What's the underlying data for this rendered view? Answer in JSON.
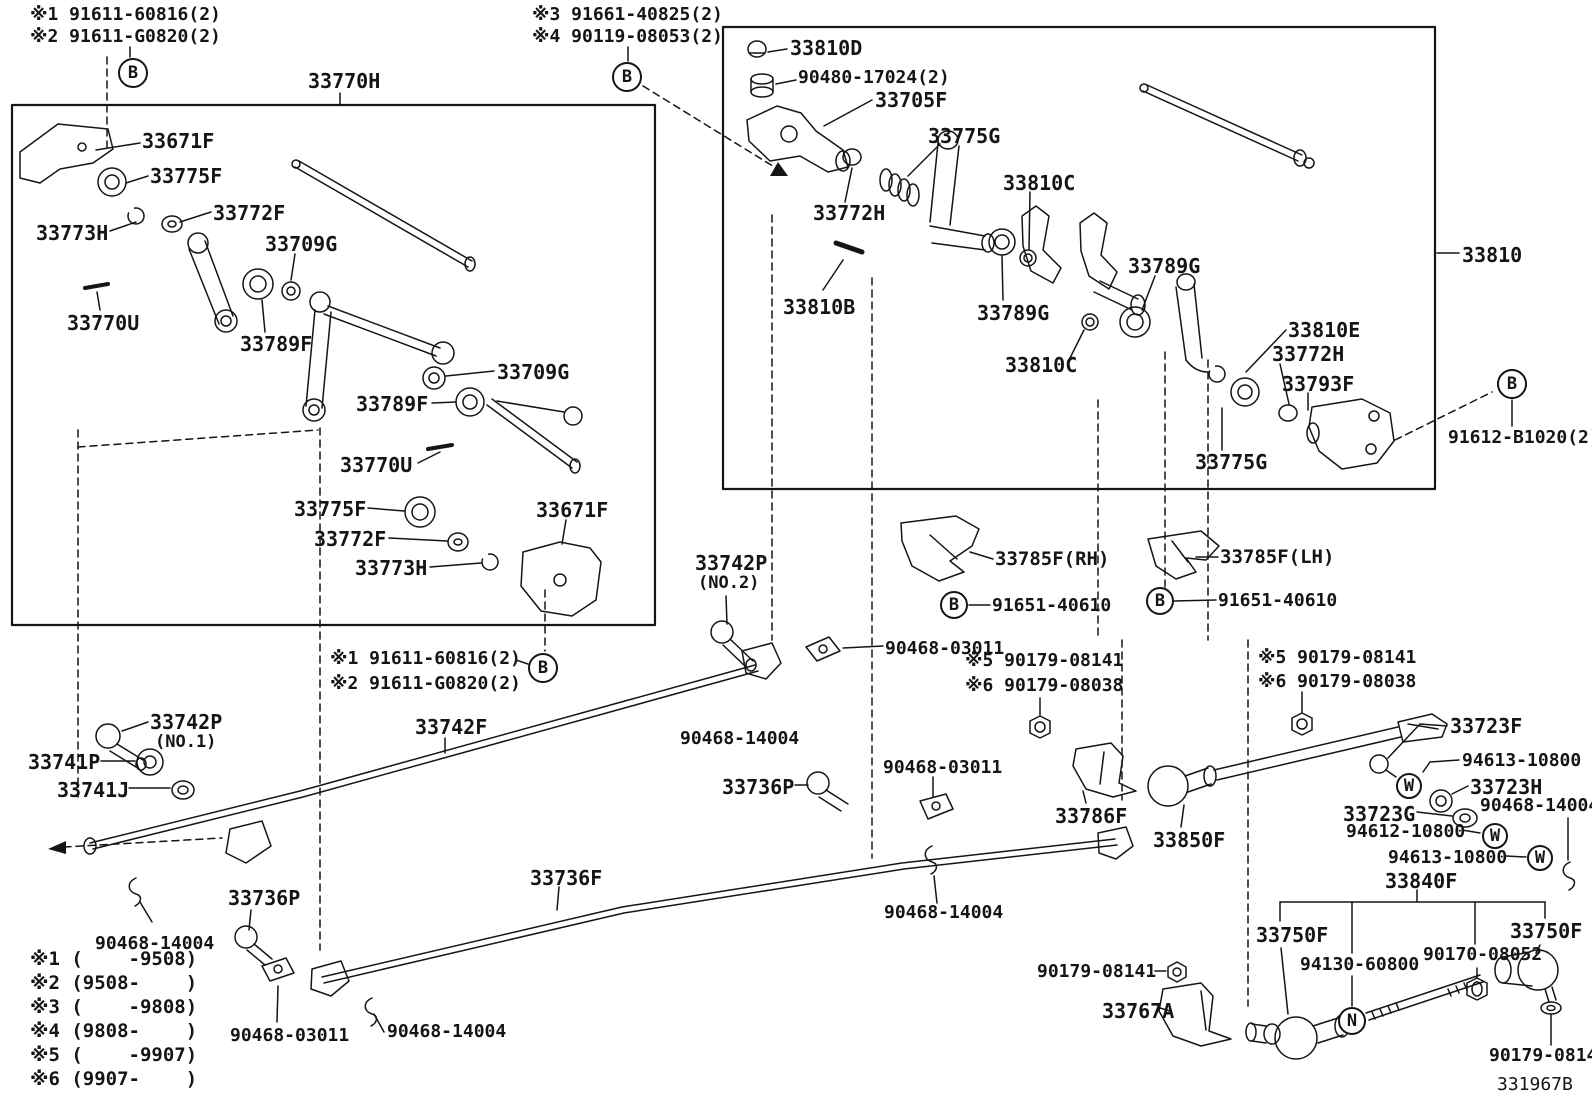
{
  "diagram": {
    "code": "331967B",
    "kind": "parts-diagram",
    "assembly_boxes": [
      {
        "id": "33770H",
        "position": "upper-left"
      },
      {
        "id": "33810",
        "position": "upper-right"
      }
    ]
  },
  "labels": [
    {
      "n": "note-ref1-top",
      "t": "※1 91611-60816(2)",
      "x": 30,
      "y": 6,
      "fs": 18
    },
    {
      "n": "note-ref2-top",
      "t": "※2 91611-G0820(2)",
      "x": 30,
      "y": 28,
      "fs": 18
    },
    {
      "n": "note-ref3-top",
      "t": "※3 91661-40825(2)",
      "x": 532,
      "y": 6,
      "fs": 18
    },
    {
      "n": "note-ref4-top",
      "t": "※4 90119-08053(2)",
      "x": 532,
      "y": 28,
      "fs": 18
    },
    {
      "n": "label-33770H",
      "t": "33770H",
      "x": 308,
      "y": 71,
      "fs": 20
    },
    {
      "n": "label-33671F-1",
      "t": "33671F",
      "x": 142,
      "y": 131,
      "fs": 20
    },
    {
      "n": "label-33775F-1",
      "t": "33775F",
      "x": 150,
      "y": 166,
      "fs": 20
    },
    {
      "n": "label-33772F-1",
      "t": "33772F",
      "x": 213,
      "y": 203,
      "fs": 20
    },
    {
      "n": "label-33773H-1",
      "t": "33773H",
      "x": 36,
      "y": 223,
      "fs": 20
    },
    {
      "n": "label-33709G-1",
      "t": "33709G",
      "x": 265,
      "y": 234,
      "fs": 20
    },
    {
      "n": "label-33770U-1",
      "t": "33770U",
      "x": 67,
      "y": 313,
      "fs": 20
    },
    {
      "n": "label-33789F-1",
      "t": "33789F",
      "x": 240,
      "y": 334,
      "fs": 20
    },
    {
      "n": "label-33709G-2",
      "t": "33709G",
      "x": 497,
      "y": 362,
      "fs": 20
    },
    {
      "n": "label-33789F-2",
      "t": "33789F",
      "x": 356,
      "y": 394,
      "fs": 20
    },
    {
      "n": "label-33770U-2",
      "t": "33770U",
      "x": 340,
      "y": 455,
      "fs": 20
    },
    {
      "n": "label-33775F-2",
      "t": "33775F",
      "x": 294,
      "y": 499,
      "fs": 20
    },
    {
      "n": "label-33772F-2",
      "t": "33772F",
      "x": 314,
      "y": 529,
      "fs": 20
    },
    {
      "n": "label-33773H-2",
      "t": "33773H",
      "x": 355,
      "y": 558,
      "fs": 20
    },
    {
      "n": "label-33671F-2",
      "t": "33671F",
      "x": 536,
      "y": 500,
      "fs": 20
    },
    {
      "n": "label-33810D",
      "t": "33810D",
      "x": 790,
      "y": 38,
      "fs": 20
    },
    {
      "n": "label-90480-17024",
      "t": "90480-17024(2)",
      "x": 798,
      "y": 69,
      "fs": 18
    },
    {
      "n": "label-33705F",
      "t": "33705F",
      "x": 875,
      "y": 90,
      "fs": 20
    },
    {
      "n": "label-33775G-1",
      "t": "33775G",
      "x": 928,
      "y": 126,
      "fs": 20
    },
    {
      "n": "label-33810C-1",
      "t": "33810C",
      "x": 1003,
      "y": 173,
      "fs": 20
    },
    {
      "n": "label-33772H-1",
      "t": "33772H",
      "x": 813,
      "y": 203,
      "fs": 20
    },
    {
      "n": "label-33810B",
      "t": "33810B",
      "x": 783,
      "y": 297,
      "fs": 20
    },
    {
      "n": "label-33789G-1",
      "t": "33789G",
      "x": 977,
      "y": 303,
      "fs": 20
    },
    {
      "n": "label-33789G-2",
      "t": "33789G",
      "x": 1128,
      "y": 256,
      "fs": 20
    },
    {
      "n": "label-33810E",
      "t": "33810E",
      "x": 1288,
      "y": 320,
      "fs": 20
    },
    {
      "n": "label-33772H-2",
      "t": "33772H",
      "x": 1272,
      "y": 344,
      "fs": 20
    },
    {
      "n": "label-33810C-2",
      "t": "33810C",
      "x": 1005,
      "y": 355,
      "fs": 20
    },
    {
      "n": "label-33793F",
      "t": "33793F",
      "x": 1282,
      "y": 374,
      "fs": 20
    },
    {
      "n": "label-33775G-2",
      "t": "33775G",
      "x": 1195,
      "y": 452,
      "fs": 20
    },
    {
      "n": "label-33810",
      "t": "33810",
      "x": 1462,
      "y": 245,
      "fs": 20
    },
    {
      "n": "label-91612-B1020",
      "t": "91612-B1020(2)",
      "x": 1448,
      "y": 429,
      "fs": 18
    },
    {
      "n": "label-33785F-RH",
      "t": "33785F(RH)",
      "x": 995,
      "y": 550,
      "fs": 19
    },
    {
      "n": "label-91651-40610-1",
      "t": "91651-40610",
      "x": 992,
      "y": 597,
      "fs": 18
    },
    {
      "n": "label-33785F-LH",
      "t": "33785F(LH)",
      "x": 1220,
      "y": 548,
      "fs": 19
    },
    {
      "n": "label-91651-40610-2",
      "t": "91651-40610",
      "x": 1218,
      "y": 592,
      "fs": 18
    },
    {
      "n": "label-33742P-no2",
      "t": "33742P",
      "x": 695,
      "y": 553,
      "fs": 20
    },
    {
      "n": "label-33742P-no2-sub",
      "t": "(NO.2)",
      "x": 698,
      "y": 575,
      "fs": 17
    },
    {
      "n": "note-ref1-mid",
      "t": "※1 91611-60816(2)",
      "x": 330,
      "y": 650,
      "fs": 18
    },
    {
      "n": "note-ref2-mid",
      "t": "※2 91611-G0820(2)",
      "x": 330,
      "y": 675,
      "fs": 18
    },
    {
      "n": "label-90468-03011-1",
      "t": "90468-03011",
      "x": 885,
      "y": 640,
      "fs": 18
    },
    {
      "n": "label-33742F",
      "t": "33742F",
      "x": 415,
      "y": 717,
      "fs": 20
    },
    {
      "n": "label-90468-14004-1",
      "t": "90468-14004",
      "x": 680,
      "y": 730,
      "fs": 18
    },
    {
      "n": "label-33736P-1",
      "t": "33736P",
      "x": 722,
      "y": 777,
      "fs": 20
    },
    {
      "n": "label-90468-03011-2",
      "t": "90468-03011",
      "x": 883,
      "y": 759,
      "fs": 18
    },
    {
      "n": "note-ref5-1",
      "t": "※5 90179-08141",
      "x": 965,
      "y": 652,
      "fs": 18
    },
    {
      "n": "note-ref6-1",
      "t": "※6 90179-08038",
      "x": 965,
      "y": 677,
      "fs": 18
    },
    {
      "n": "note-ref5-2",
      "t": "※5 90179-08141",
      "x": 1258,
      "y": 649,
      "fs": 18
    },
    {
      "n": "note-ref6-2",
      "t": "※6 90179-08038",
      "x": 1258,
      "y": 673,
      "fs": 18
    },
    {
      "n": "label-33723F",
      "t": "33723F",
      "x": 1450,
      "y": 716,
      "fs": 20
    },
    {
      "n": "label-94613-10800-1",
      "t": "94613-10800",
      "x": 1462,
      "y": 752,
      "fs": 18
    },
    {
      "n": "label-33723H",
      "t": "33723H",
      "x": 1470,
      "y": 777,
      "fs": 20
    },
    {
      "n": "label-33723G",
      "t": "33723G",
      "x": 1343,
      "y": 804,
      "fs": 20
    },
    {
      "n": "label-90468-14004-2",
      "t": "90468-14004",
      "x": 1480,
      "y": 797,
      "fs": 18
    },
    {
      "n": "label-94612-10800",
      "t": "94612-10800",
      "x": 1346,
      "y": 823,
      "fs": 18
    },
    {
      "n": "label-94613-10800-2",
      "t": "94613-10800",
      "x": 1388,
      "y": 849,
      "fs": 18
    },
    {
      "n": "label-33840F",
      "t": "33840F",
      "x": 1385,
      "y": 871,
      "fs": 20
    },
    {
      "n": "label-33786F",
      "t": "33786F",
      "x": 1055,
      "y": 806,
      "fs": 20
    },
    {
      "n": "label-33850F",
      "t": "33850F",
      "x": 1153,
      "y": 830,
      "fs": 20
    },
    {
      "n": "label-33742P-no1",
      "t": "33742P",
      "x": 150,
      "y": 712,
      "fs": 20
    },
    {
      "n": "label-33742P-no1-sub",
      "t": "(NO.1)",
      "x": 155,
      "y": 734,
      "fs": 17
    },
    {
      "n": "label-33741P",
      "t": "33741P",
      "x": 28,
      "y": 752,
      "fs": 20
    },
    {
      "n": "label-33741J",
      "t": "33741J",
      "x": 57,
      "y": 780,
      "fs": 20
    },
    {
      "n": "label-90468-14004-3",
      "t": "90468-14004",
      "x": 95,
      "y": 935,
      "fs": 18
    },
    {
      "n": "label-33736P-2",
      "t": "33736P",
      "x": 228,
      "y": 888,
      "fs": 20
    },
    {
      "n": "label-90468-03011-3",
      "t": "90468-03011",
      "x": 230,
      "y": 1027,
      "fs": 18
    },
    {
      "n": "label-90468-14004-4",
      "t": "90468-14004",
      "x": 387,
      "y": 1023,
      "fs": 18
    },
    {
      "n": "label-33736F",
      "t": "33736F",
      "x": 530,
      "y": 868,
      "fs": 20
    },
    {
      "n": "label-90468-14004-5",
      "t": "90468-14004",
      "x": 884,
      "y": 904,
      "fs": 18
    },
    {
      "n": "label-90179-08141-1",
      "t": "90179-08141",
      "x": 1037,
      "y": 963,
      "fs": 18
    },
    {
      "n": "label-33767A",
      "t": "33767A",
      "x": 1102,
      "y": 1001,
      "fs": 20
    },
    {
      "n": "label-33750F-1",
      "t": "33750F",
      "x": 1256,
      "y": 925,
      "fs": 20
    },
    {
      "n": "label-94130-60800",
      "t": "94130-60800",
      "x": 1300,
      "y": 956,
      "fs": 18
    },
    {
      "n": "label-90170-08052",
      "t": "90170-08052",
      "x": 1423,
      "y": 946,
      "fs": 18
    },
    {
      "n": "label-33750F-2",
      "t": "33750F",
      "x": 1510,
      "y": 921,
      "fs": 20
    },
    {
      "n": "label-90179-08141-2",
      "t": "90179-08141",
      "x": 1489,
      "y": 1047,
      "fs": 18
    },
    {
      "n": "diagram-code",
      "t": "331967B",
      "x": 1497,
      "y": 1076,
      "fs": 18,
      "w": "400"
    }
  ],
  "callouts": [
    {
      "l": "B",
      "x": 133,
      "y": 73,
      "r": 15
    },
    {
      "l": "B",
      "x": 627,
      "y": 77,
      "r": 15
    },
    {
      "l": "B",
      "x": 543,
      "y": 668,
      "r": 15
    },
    {
      "l": "B",
      "x": 954,
      "y": 605,
      "r": 14
    },
    {
      "l": "B",
      "x": 1160,
      "y": 601,
      "r": 14
    },
    {
      "l": "B",
      "x": 1512,
      "y": 384,
      "r": 15
    },
    {
      "l": "W",
      "x": 1409,
      "y": 786,
      "r": 13
    },
    {
      "l": "W",
      "x": 1495,
      "y": 836,
      "r": 13
    },
    {
      "l": "W",
      "x": 1540,
      "y": 858,
      "r": 13
    },
    {
      "l": "N",
      "x": 1352,
      "y": 1021,
      "r": 14
    }
  ],
  "legend": {
    "x": 30,
    "y": 950,
    "row_height": 24,
    "entries": [
      "※1 (    -9508)",
      "※2 (9508-    )",
      "※3 (    -9808)",
      "※4 (9808-    )",
      "※5 (    -9907)",
      "※6 (9907-    )"
    ]
  }
}
